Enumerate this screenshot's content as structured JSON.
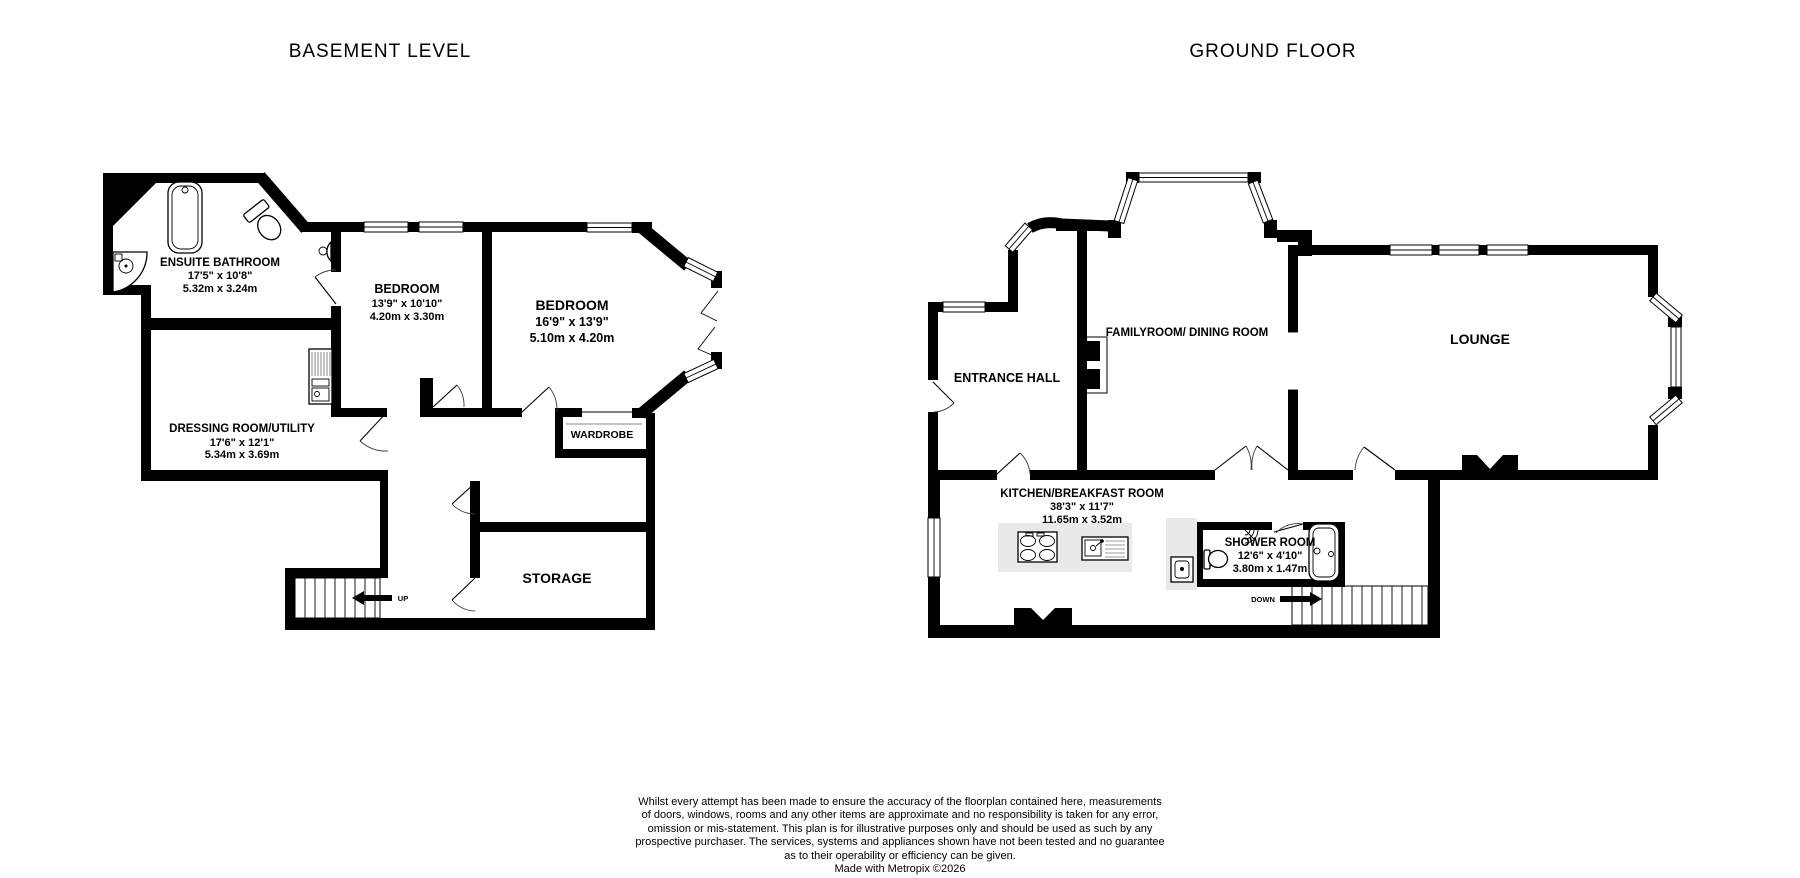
{
  "basement": {
    "title": "BASEMENT LEVEL",
    "rooms": [
      {
        "name": "ENSUITE BATHROOM",
        "imperial": "17'5\"  x 10'8\"",
        "metric": "5.32m  x 3.24m"
      },
      {
        "name": "BEDROOM",
        "imperial": "13'9\"  x 10'10\"",
        "metric": "4.20m  x 3.30m"
      },
      {
        "name": "BEDROOM",
        "imperial": "16'9\"  x 13'9\"",
        "metric": "5.10m  x 4.20m"
      },
      {
        "name": "DRESSING ROOM/UTILITY",
        "imperial": "17'6\"  x 12'1\"",
        "metric": "5.34m  x 3.69m"
      },
      {
        "name": "WARDROBE"
      },
      {
        "name": "STORAGE"
      }
    ],
    "stairs_label": "UP"
  },
  "ground": {
    "title": "GROUND FLOOR",
    "rooms": [
      {
        "name": "ENTRANCE HALL"
      },
      {
        "name": "FAMILYROOM/ DINING ROOM"
      },
      {
        "name": "LOUNGE"
      },
      {
        "name": "KITCHEN/BREAKFAST ROOM",
        "imperial": "38'3\"  x 11'7\"",
        "metric": "11.65m  x 3.52m"
      },
      {
        "name": "SHOWER ROOM",
        "imperial": "12'6\"  x 4'10\"",
        "metric": "3.80m  x 1.47m"
      }
    ],
    "stairs_label": "DOWN"
  },
  "disclaimer": {
    "lines": [
      "Whilst every attempt has been made to ensure the accuracy of the floorplan contained here, measurements",
      "of doors, windows, rooms and any other items are approximate and no responsibility is taken for any error,",
      "omission or mis-statement. This plan is for illustrative purposes only and should be used as such by any",
      "prospective purchaser. The services, systems and appliances shown have not been tested and no guarantee",
      "as to their operability or efficiency can be given."
    ],
    "credit": "Made with Metropix ©2026"
  },
  "colors": {
    "wall": "#000000",
    "counter": "#e9e9e9",
    "background": "#ffffff"
  }
}
